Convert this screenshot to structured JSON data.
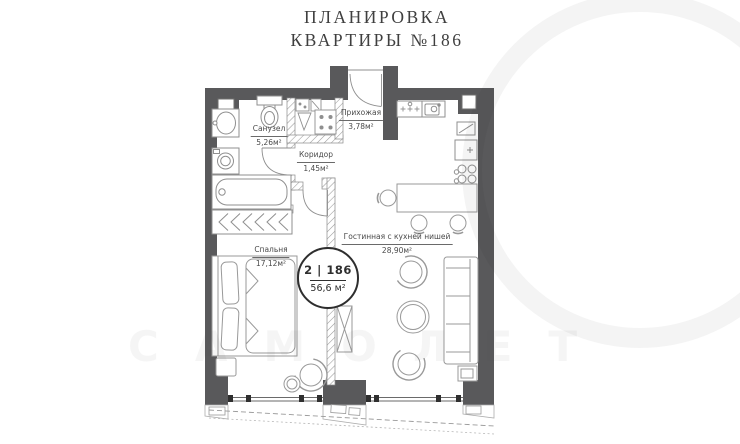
{
  "title": {
    "line1": "ПЛАНИРОВКА",
    "line2": "КВАРТИРЫ №186"
  },
  "badge": {
    "unit": "2 | 186",
    "area": "56,6 м²"
  },
  "rooms": {
    "sanuzel": {
      "name": "Санузел",
      "area": "5,26м²"
    },
    "prihozhaya": {
      "name": "Прихожая",
      "area": "3,78м²"
    },
    "koridor": {
      "name": "Коридор",
      "area": "1,45м²"
    },
    "spalnya": {
      "name": "Спальня",
      "area": "17,12м²"
    },
    "gostinaya": {
      "name": "Гостинная с кухней нишей",
      "area": "28,90м²"
    }
  },
  "watermark": {
    "text": "САМОЛЕТ"
  },
  "colors": {
    "wall": "#59595b",
    "furniture_line": "#999999",
    "fixture_line": "#8f8f8f",
    "text": "#4a4a4a",
    "title_text": "#3f3f3f",
    "badge_border": "#2e2e2e"
  }
}
